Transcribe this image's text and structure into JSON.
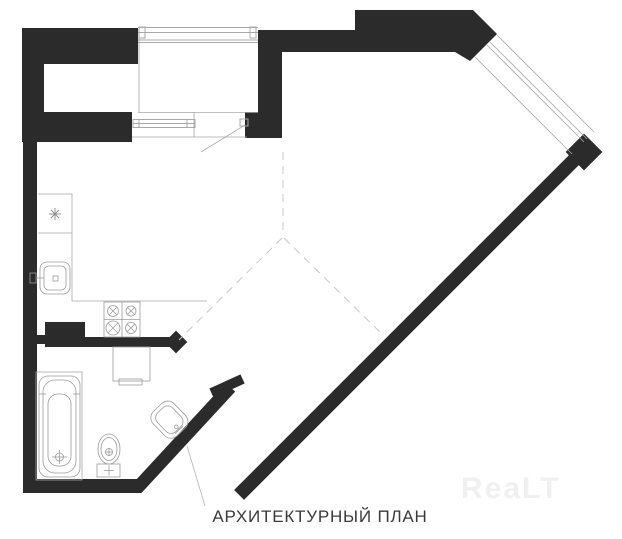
{
  "caption": {
    "text": "АРХИТЕКТУРНЫЙ ПЛАН"
  },
  "watermark": {
    "text": "ReaLT"
  },
  "colors": {
    "background": "#ffffff",
    "wall-color": "#2b2b2b",
    "line-color": "#a8a8a8",
    "dashed-color": "#c8c8c8",
    "caption-color": "#3a3a3a",
    "watermark-color": "#f0f0f0"
  }
}
